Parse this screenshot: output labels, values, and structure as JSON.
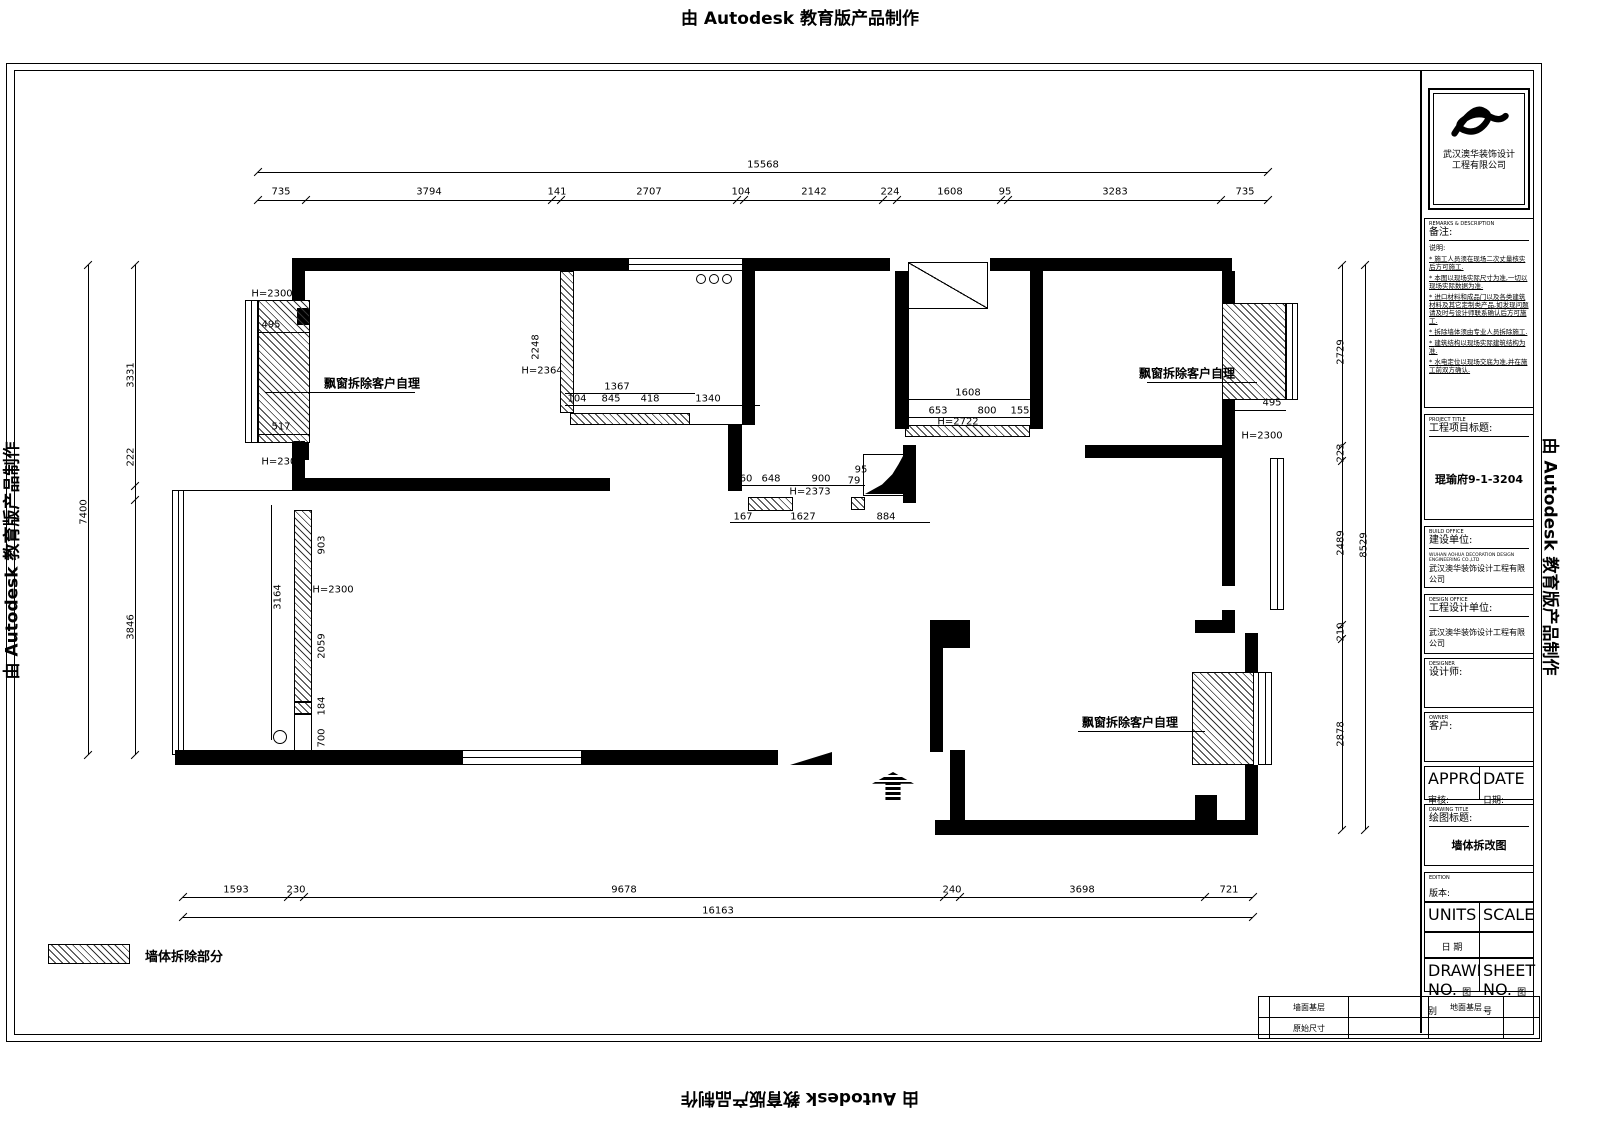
{
  "watermark": {
    "text": "由 Autodesk 教育版产品制作"
  },
  "legend": {
    "label": "墙体拆除部分"
  },
  "plan": {
    "geometry": [
      {
        "t": "wall",
        "x": 292,
        "y": 258,
        "w": 336,
        "h": 13
      },
      {
        "t": "wall",
        "x": 748,
        "y": 258,
        "w": 142,
        "h": 13
      },
      {
        "t": "wall",
        "x": 990,
        "y": 258,
        "w": 242,
        "h": 13
      },
      {
        "t": "wall",
        "x": 292,
        "y": 271,
        "w": 13,
        "h": 30
      },
      {
        "t": "wall",
        "x": 292,
        "y": 441,
        "w": 13,
        "h": 50
      },
      {
        "t": "wall",
        "x": 292,
        "y": 478,
        "w": 318,
        "h": 13
      },
      {
        "t": "wall",
        "x": 742,
        "y": 258,
        "w": 13,
        "h": 167
      },
      {
        "t": "wall",
        "x": 728,
        "y": 425,
        "w": 14,
        "h": 66
      },
      {
        "t": "wall",
        "x": 895,
        "y": 271,
        "w": 14,
        "h": 158
      },
      {
        "t": "wall",
        "x": 1030,
        "y": 271,
        "w": 13,
        "h": 158
      },
      {
        "t": "wall",
        "x": 1222,
        "y": 271,
        "w": 13,
        "h": 32
      },
      {
        "t": "wall",
        "x": 1222,
        "y": 400,
        "w": 13,
        "h": 58
      },
      {
        "t": "wall",
        "x": 1085,
        "y": 445,
        "w": 150,
        "h": 13
      },
      {
        "t": "wall",
        "x": 1222,
        "y": 458,
        "w": 13,
        "h": 128
      },
      {
        "t": "wall",
        "x": 1222,
        "y": 610,
        "w": 13,
        "h": 23
      },
      {
        "t": "wall",
        "x": 1195,
        "y": 620,
        "w": 40,
        "h": 13
      },
      {
        "t": "wall",
        "x": 1245,
        "y": 633,
        "w": 13,
        "h": 40
      },
      {
        "t": "wall",
        "x": 1245,
        "y": 765,
        "w": 13,
        "h": 57
      },
      {
        "t": "wall",
        "x": 935,
        "y": 820,
        "w": 323,
        "h": 15
      },
      {
        "t": "wall",
        "x": 950,
        "y": 750,
        "w": 15,
        "h": 85
      },
      {
        "t": "wall",
        "x": 175,
        "y": 750,
        "w": 287,
        "h": 15
      },
      {
        "t": "wall",
        "x": 582,
        "y": 750,
        "w": 196,
        "h": 15
      },
      {
        "t": "wall",
        "x": 930,
        "y": 620,
        "w": 40,
        "h": 28
      },
      {
        "t": "wall",
        "x": 930,
        "y": 648,
        "w": 13,
        "h": 104
      },
      {
        "t": "wall",
        "x": 1195,
        "y": 795,
        "w": 22,
        "h": 25
      },
      {
        "t": "wall",
        "x": 297,
        "y": 308,
        "w": 12,
        "h": 17
      },
      {
        "t": "wall",
        "x": 297,
        "y": 443,
        "w": 12,
        "h": 17
      },
      {
        "t": "wall",
        "x": 903,
        "y": 445,
        "w": 13,
        "h": 58
      },
      {
        "t": "hatch",
        "x": 258,
        "y": 300,
        "w": 52,
        "h": 143,
        "n": "demolition-hatch"
      },
      {
        "t": "hatch",
        "x": 294,
        "y": 510,
        "w": 18,
        "h": 192,
        "n": "demolition-hatch"
      },
      {
        "t": "hatch",
        "x": 294,
        "y": 702,
        "w": 18,
        "h": 12,
        "n": "demolition-hatch"
      },
      {
        "t": "hatch",
        "x": 560,
        "y": 271,
        "w": 14,
        "h": 142,
        "n": "demolition-hatch"
      },
      {
        "t": "hatch",
        "x": 570,
        "y": 413,
        "w": 120,
        "h": 12,
        "n": "demolition-hatch"
      },
      {
        "t": "hatch",
        "x": 905,
        "y": 425,
        "w": 125,
        "h": 12,
        "n": "demolition-hatch"
      },
      {
        "t": "hatch",
        "x": 851,
        "y": 497,
        "w": 14,
        "h": 13,
        "n": "demolition-hatch"
      },
      {
        "t": "hatch",
        "x": 748,
        "y": 497,
        "w": 45,
        "h": 14,
        "n": "demolition-hatch"
      },
      {
        "t": "hatch",
        "x": 1222,
        "y": 303,
        "w": 64,
        "h": 97,
        "n": "demolition-hatch"
      },
      {
        "t": "hatch",
        "x": 1192,
        "y": 672,
        "w": 62,
        "h": 93,
        "n": "demolition-hatch"
      },
      {
        "t": "hatch",
        "x": 48,
        "y": 944,
        "w": 82,
        "h": 20,
        "n": "legend-swatch"
      },
      {
        "t": "winv",
        "x": 245,
        "y": 300,
        "w": 13,
        "h": 143,
        "n": "window"
      },
      {
        "t": "winh",
        "x": 628,
        "y": 258,
        "w": 120,
        "h": 13,
        "n": "window"
      },
      {
        "t": "winh",
        "x": 462,
        "y": 750,
        "w": 120,
        "h": 15,
        "n": "window"
      },
      {
        "t": "winv",
        "x": 172,
        "y": 490,
        "w": 12,
        "h": 265,
        "n": "window"
      },
      {
        "t": "winv",
        "x": 1270,
        "y": 458,
        "w": 14,
        "h": 152,
        "n": "window"
      },
      {
        "t": "winv",
        "x": 1258,
        "y": 672,
        "w": 14,
        "h": 93,
        "n": "window"
      },
      {
        "t": "winv",
        "x": 1286,
        "y": 303,
        "w": 12,
        "h": 97,
        "n": "window"
      },
      {
        "t": "diagbox",
        "x": 908,
        "y": 262,
        "w": 80,
        "h": 47,
        "n": "shaft"
      },
      {
        "t": "box",
        "x": 294,
        "y": 714,
        "w": 18,
        "h": 38
      },
      {
        "t": "box",
        "x": 863,
        "y": 454,
        "w": 42,
        "h": 42
      },
      {
        "t": "blob",
        "x": 865,
        "y": 456,
        "w": 38,
        "h": 38,
        "n": "corner-fixture"
      },
      {
        "t": "tri",
        "x": 790,
        "y": 752,
        "w": 42,
        "h": 13,
        "n": "door-symbol"
      },
      {
        "t": "arrow",
        "x": 872,
        "y": 772,
        "w": 42,
        "h": 28,
        "n": "entry-arrow"
      },
      {
        "t": "circle",
        "x": 696,
        "y": 274,
        "w": 10,
        "h": 10,
        "n": "stove-burner"
      },
      {
        "t": "circle",
        "x": 709,
        "y": 274,
        "w": 10,
        "h": 10,
        "n": "stove-burner"
      },
      {
        "t": "circle",
        "x": 722,
        "y": 274,
        "w": 10,
        "h": 10,
        "n": "stove-burner"
      },
      {
        "t": "circle",
        "x": 898,
        "y": 314,
        "w": 9,
        "h": 9
      },
      {
        "t": "circle",
        "x": 898,
        "y": 326,
        "w": 9,
        "h": 9
      },
      {
        "t": "circle",
        "x": 273,
        "y": 730,
        "w": 14,
        "h": 14
      },
      {
        "t": "lineh",
        "x": 258,
        "y": 172,
        "w": 1010,
        "h": 1,
        "n": "dim-line"
      },
      {
        "t": "lineh",
        "x": 258,
        "y": 200,
        "w": 1010,
        "h": 1,
        "n": "dim-line"
      },
      {
        "t": "lineh",
        "x": 183,
        "y": 897,
        "w": 1070,
        "h": 1,
        "n": "dim-line"
      },
      {
        "t": "lineh",
        "x": 183,
        "y": 917,
        "w": 1070,
        "h": 1,
        "n": "dim-line"
      },
      {
        "t": "linev",
        "x": 88,
        "y": 265,
        "w": 1,
        "h": 490,
        "n": "dim-line"
      },
      {
        "t": "linev",
        "x": 135,
        "y": 265,
        "w": 1,
        "h": 490,
        "n": "dim-line"
      },
      {
        "t": "linev",
        "x": 1342,
        "y": 265,
        "w": 1,
        "h": 565,
        "n": "dim-line"
      },
      {
        "t": "linev",
        "x": 1365,
        "y": 265,
        "w": 1,
        "h": 565,
        "n": "dim-line"
      },
      {
        "t": "lineh",
        "x": 265,
        "y": 392,
        "w": 150,
        "h": 1,
        "n": "leader-line"
      },
      {
        "t": "lineh",
        "x": 1147,
        "y": 382,
        "w": 110,
        "h": 1,
        "n": "leader-line"
      },
      {
        "t": "lineh",
        "x": 1078,
        "y": 731,
        "w": 127,
        "h": 1,
        "n": "leader-line"
      },
      {
        "t": "lineh",
        "x": 172,
        "y": 490,
        "w": 122,
        "h": 1
      },
      {
        "t": "lineh",
        "x": 690,
        "y": 424,
        "w": 65,
        "h": 1
      },
      {
        "t": "lineh",
        "x": 565,
        "y": 393,
        "w": 130,
        "h": 1,
        "n": "dim-line"
      },
      {
        "t": "lineh",
        "x": 565,
        "y": 405,
        "w": 195,
        "h": 1,
        "n": "dim-line"
      },
      {
        "t": "lineh",
        "x": 905,
        "y": 399,
        "w": 125,
        "h": 1,
        "n": "dim-line"
      },
      {
        "t": "lineh",
        "x": 905,
        "y": 417,
        "w": 125,
        "h": 1,
        "n": "dim-line"
      },
      {
        "t": "lineh",
        "x": 740,
        "y": 485,
        "w": 125,
        "h": 1,
        "n": "dim-line"
      },
      {
        "t": "lineh",
        "x": 730,
        "y": 522,
        "w": 200,
        "h": 1,
        "n": "dim-line"
      },
      {
        "t": "lineh",
        "x": 258,
        "y": 332,
        "w": 52,
        "h": 1,
        "n": "dim-line"
      },
      {
        "t": "lineh",
        "x": 258,
        "y": 434,
        "w": 52,
        "h": 1,
        "n": "dim-line"
      },
      {
        "t": "lineh",
        "x": 1222,
        "y": 410,
        "w": 64,
        "h": 1,
        "n": "dim-line"
      },
      {
        "t": "linev",
        "x": 271,
        "y": 505,
        "w": 1,
        "h": 235,
        "n": "dim-line"
      },
      {
        "t": "tick",
        "x": 258,
        "y": 200
      },
      {
        "t": "tick",
        "x": 306,
        "y": 200
      },
      {
        "t": "tick",
        "x": 552,
        "y": 200
      },
      {
        "t": "tick",
        "x": 561,
        "y": 200
      },
      {
        "t": "tick",
        "x": 737,
        "y": 200
      },
      {
        "t": "tick",
        "x": 744,
        "y": 200
      },
      {
        "t": "tick",
        "x": 883,
        "y": 200
      },
      {
        "t": "tick",
        "x": 897,
        "y": 200
      },
      {
        "t": "tick",
        "x": 1001,
        "y": 200
      },
      {
        "t": "tick",
        "x": 1008,
        "y": 200
      },
      {
        "t": "tick",
        "x": 1221,
        "y": 200
      },
      {
        "t": "tick",
        "x": 1268,
        "y": 200
      },
      {
        "t": "tick",
        "x": 258,
        "y": 172
      },
      {
        "t": "tick",
        "x": 1268,
        "y": 172
      },
      {
        "t": "tick",
        "x": 183,
        "y": 897
      },
      {
        "t": "tick",
        "x": 288,
        "y": 897
      },
      {
        "t": "tick",
        "x": 304,
        "y": 897
      },
      {
        "t": "tick",
        "x": 944,
        "y": 897
      },
      {
        "t": "tick",
        "x": 960,
        "y": 897
      },
      {
        "t": "tick",
        "x": 1205,
        "y": 897
      },
      {
        "t": "tick",
        "x": 1253,
        "y": 897
      },
      {
        "t": "tick",
        "x": 183,
        "y": 917
      },
      {
        "t": "tick",
        "x": 1253,
        "y": 917
      },
      {
        "t": "tick",
        "x": 135,
        "y": 265
      },
      {
        "t": "tick",
        "x": 135,
        "y": 486
      },
      {
        "t": "tick",
        "x": 135,
        "y": 500
      },
      {
        "t": "tick",
        "x": 135,
        "y": 755
      },
      {
        "t": "tick",
        "x": 88,
        "y": 265
      },
      {
        "t": "tick",
        "x": 88,
        "y": 755
      },
      {
        "t": "tick",
        "x": 1342,
        "y": 265
      },
      {
        "t": "tick",
        "x": 1342,
        "y": 446
      },
      {
        "t": "tick",
        "x": 1342,
        "y": 461
      },
      {
        "t": "tick",
        "x": 1342,
        "y": 625
      },
      {
        "t": "tick",
        "x": 1342,
        "y": 639
      },
      {
        "t": "tick",
        "x": 1342,
        "y": 830
      },
      {
        "t": "tick",
        "x": 1365,
        "y": 265
      },
      {
        "t": "tick",
        "x": 1365,
        "y": 830
      }
    ],
    "labels": [
      {
        "t": "15568",
        "x": 763,
        "y": 165
      },
      {
        "t": "735",
        "x": 281,
        "y": 192
      },
      {
        "t": "3794",
        "x": 429,
        "y": 192
      },
      {
        "t": "141",
        "x": 557,
        "y": 192
      },
      {
        "t": "2707",
        "x": 649,
        "y": 192
      },
      {
        "t": "104",
        "x": 741,
        "y": 192
      },
      {
        "t": "2142",
        "x": 814,
        "y": 192
      },
      {
        "t": "224",
        "x": 890,
        "y": 192
      },
      {
        "t": "1608",
        "x": 950,
        "y": 192
      },
      {
        "t": "95",
        "x": 1005,
        "y": 192
      },
      {
        "t": "3283",
        "x": 1115,
        "y": 192
      },
      {
        "t": "735",
        "x": 1245,
        "y": 192
      },
      {
        "t": "1593",
        "x": 236,
        "y": 890
      },
      {
        "t": "230",
        "x": 296,
        "y": 890
      },
      {
        "t": "9678",
        "x": 624,
        "y": 890
      },
      {
        "t": "240",
        "x": 952,
        "y": 890
      },
      {
        "t": "3698",
        "x": 1082,
        "y": 890
      },
      {
        "t": "721",
        "x": 1229,
        "y": 890
      },
      {
        "t": "16163",
        "x": 718,
        "y": 911
      },
      {
        "t": "7400",
        "x": 84,
        "y": 512,
        "r": 1
      },
      {
        "t": "3331",
        "x": 131,
        "y": 375,
        "r": 1
      },
      {
        "t": "222",
        "x": 131,
        "y": 457,
        "r": 1
      },
      {
        "t": "3846",
        "x": 131,
        "y": 627,
        "r": 1
      },
      {
        "t": "2729",
        "x": 1341,
        "y": 352,
        "r": 1
      },
      {
        "t": "223",
        "x": 1341,
        "y": 453,
        "r": 1
      },
      {
        "t": "2489",
        "x": 1341,
        "y": 543,
        "r": 1
      },
      {
        "t": "210",
        "x": 1341,
        "y": 632,
        "r": 1
      },
      {
        "t": "2878",
        "x": 1341,
        "y": 734,
        "r": 1
      },
      {
        "t": "8529",
        "x": 1364,
        "y": 545,
        "r": 1
      },
      {
        "t": "H=2300",
        "x": 272,
        "y": 294
      },
      {
        "t": "495",
        "x": 271,
        "y": 325
      },
      {
        "t": "517",
        "x": 281,
        "y": 427
      },
      {
        "t": "H=2300",
        "x": 282,
        "y": 462
      },
      {
        "t": "2248",
        "x": 536,
        "y": 347,
        "r": 1
      },
      {
        "t": "H=2364",
        "x": 542,
        "y": 371
      },
      {
        "t": "1367",
        "x": 617,
        "y": 387
      },
      {
        "t": "104",
        "x": 577,
        "y": 399
      },
      {
        "t": "845",
        "x": 611,
        "y": 399
      },
      {
        "t": "418",
        "x": 650,
        "y": 399
      },
      {
        "t": "1340",
        "x": 708,
        "y": 399
      },
      {
        "t": "1608",
        "x": 968,
        "y": 393
      },
      {
        "t": "653",
        "x": 938,
        "y": 411
      },
      {
        "t": "800",
        "x": 987,
        "y": 411
      },
      {
        "t": "155",
        "x": 1020,
        "y": 411
      },
      {
        "t": "H=2722",
        "x": 958,
        "y": 422
      },
      {
        "t": "60",
        "x": 746,
        "y": 479
      },
      {
        "t": "648",
        "x": 771,
        "y": 479
      },
      {
        "t": "900",
        "x": 821,
        "y": 479
      },
      {
        "t": "95",
        "x": 861,
        "y": 470
      },
      {
        "t": "79",
        "x": 854,
        "y": 481
      },
      {
        "t": "H=2373",
        "x": 810,
        "y": 492
      },
      {
        "t": "167",
        "x": 743,
        "y": 517
      },
      {
        "t": "1627",
        "x": 803,
        "y": 517
      },
      {
        "t": "884",
        "x": 886,
        "y": 517
      },
      {
        "t": "3164",
        "x": 278,
        "y": 597,
        "r": 1
      },
      {
        "t": "903",
        "x": 322,
        "y": 545,
        "r": 1
      },
      {
        "t": "H=2300",
        "x": 333,
        "y": 590
      },
      {
        "t": "2059",
        "x": 322,
        "y": 646,
        "r": 1
      },
      {
        "t": "184",
        "x": 322,
        "y": 706,
        "r": 1
      },
      {
        "t": "700",
        "x": 322,
        "y": 738,
        "r": 1
      },
      {
        "t": "495",
        "x": 1272,
        "y": 403
      },
      {
        "t": "H=2300",
        "x": 1262,
        "y": 436
      },
      {
        "t": "飘窗拆除客户自理",
        "x": 372,
        "y": 383,
        "c": "note"
      },
      {
        "t": "飘窗拆除客户自理",
        "x": 1187,
        "y": 373,
        "c": "note"
      },
      {
        "t": "飘窗拆除客户自理",
        "x": 1130,
        "y": 722,
        "c": "note"
      }
    ]
  },
  "title_block": {
    "logo_company_line1": "武汉澳华装饰设计",
    "logo_company_line2": "工程有限公司",
    "remarks": {
      "en": "REMARKS & DESCRIPTION",
      "label": "备注:",
      "desc_label": "说明:",
      "notes": [
        "施工人员须在现场二次丈量核实后方可施工.",
        "本图以现场实际尺寸为准,一切以现场实际数据为准.",
        "进口材料和成品门以及各类建筑材料及其它定制类产品,如发现问题请及时与设计师联系确认后方可施工.",
        "拆除墙体须由专业人员拆除施工.",
        "建筑结构以现场实际建筑结构为准.",
        "水电定位以现场交底为准,并在施工前双方确认."
      ]
    },
    "project": {
      "en": "PROJECT TITLE",
      "label": "工程项目标题:",
      "value": "琨瑜府9-1-3204"
    },
    "owner_unit": {
      "en": "BUILD OFFICE",
      "label": "建设单位:",
      "value_en": "WUHAN AOHUA DECORATION DESIGN ENGINEERING CO.,LTD",
      "value": "武汉澳华装饰设计工程有限公司"
    },
    "design_unit": {
      "en": "DESIGN OFFICE",
      "label": "工程设计单位:",
      "value": "武汉澳华装饰设计工程有限公司"
    },
    "designer": {
      "en": "DESIGNER",
      "label": "设计师:"
    },
    "customer": {
      "en": "OWNER",
      "label": "客户:"
    },
    "approve": {
      "en": "APPROVED",
      "label": "审核:"
    },
    "date1": {
      "en": "DATE",
      "label": "日期:"
    },
    "drawing_title": {
      "en": "DRAWING TITLE",
      "label": "绘图标题:",
      "value": "墙体拆改图"
    },
    "edition": {
      "en": "EDITION",
      "label": "版本:"
    },
    "units": {
      "en": "UNITS",
      "label": "单位"
    },
    "scale": {
      "en": "SCALE",
      "label": "比例"
    },
    "date2": {
      "label": "日 期"
    },
    "drawing_no": {
      "en": "DRAWING NO.",
      "label": "图别"
    },
    "sheet_no": {
      "en": "SHEET NO.",
      "label": "图号"
    }
  },
  "bottom_strip": {
    "rows": [
      [
        "",
        "墙面基层",
        "",
        "地面基层",
        ""
      ],
      [
        "",
        "原始尺寸",
        "",
        "",
        ""
      ]
    ]
  }
}
